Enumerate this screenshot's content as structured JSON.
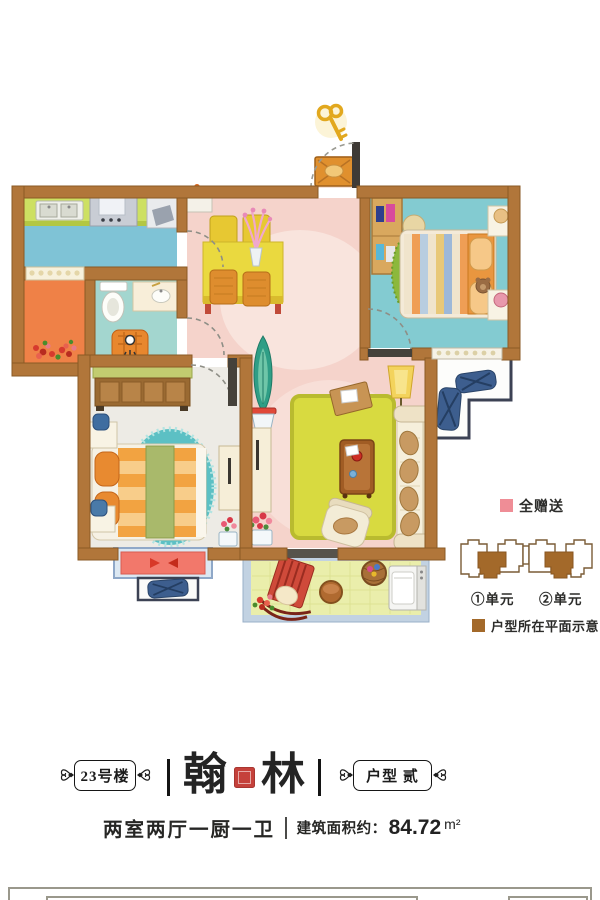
{
  "legend": {
    "gift_label": "全赠送",
    "unit_labels": [
      "①单元",
      "②单元"
    ],
    "plan_note_label": "户型所在平面示意"
  },
  "title_block": {
    "building_badge": "23号楼",
    "name_char_1": "翰",
    "name_char_2": "林",
    "type_badge": "户型 贰"
  },
  "spec_line": {
    "layout": "两室两厅一厨一卫",
    "area_label": "建筑面积约：",
    "area_value": "84.72",
    "area_unit": "m²"
  },
  "floorplan": {
    "palette": {
      "wall": "#b1763a",
      "kitchen_floor": "#7fc3d6",
      "counter_green": "#cde062",
      "bathroom_floor": "#a3d6cf",
      "dining_living_floor": "#f5d3cb",
      "bedroom_main_floor": "#83cbd1",
      "bedroom_second_floor": "#edebe5",
      "side_balcony_floor": "#ef8147",
      "balcony_floor": "#eaeeab",
      "balcony_frame": "#c2d2e2",
      "living_rug": "#d8da40",
      "bedroom_rug": "#5cc0c4",
      "ac_unit_navy": "#3d5e8e",
      "bay_window_mat": "#f2786b",
      "gift_pink": "#ef8d96",
      "unit_brown": "#a3692a",
      "seal_red": "#c5413b"
    }
  }
}
